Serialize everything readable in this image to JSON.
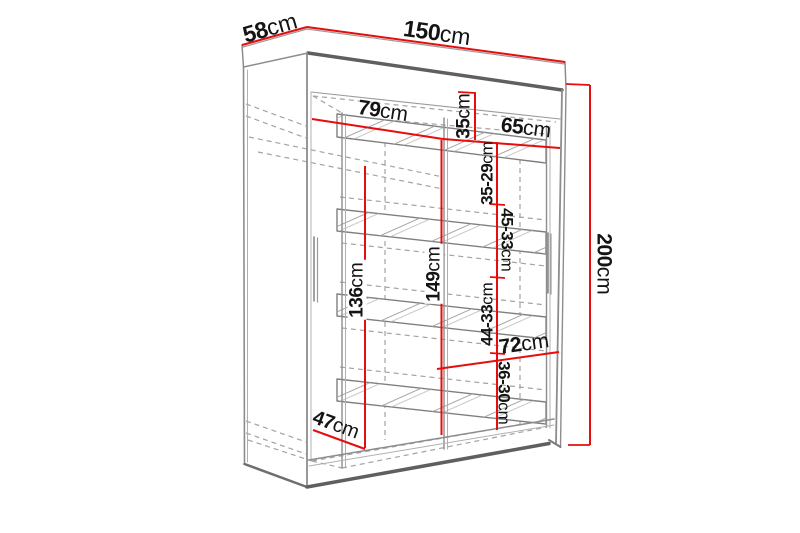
{
  "dimensions": {
    "depth": {
      "num": "58",
      "unit": "cm"
    },
    "width": {
      "num": "150",
      "unit": "cm"
    },
    "height": {
      "num": "200",
      "unit": "cm"
    },
    "left_shelf_width": {
      "num": "79",
      "unit": "cm"
    },
    "top_shelf_gap": {
      "num": "35",
      "unit": "cm"
    },
    "right_shelf_width": {
      "num": "65",
      "unit": "cm"
    },
    "right_gap_1": {
      "num": "35-29",
      "unit": "cm"
    },
    "right_gap_2": {
      "num": "45-33",
      "unit": "cm"
    },
    "hanging_space_height": {
      "num": "136",
      "unit": "cm"
    },
    "interior_height": {
      "num": "149",
      "unit": "cm"
    },
    "right_gap_3": {
      "num": "44-33",
      "unit": "cm"
    },
    "bottom_section_width": {
      "num": "72",
      "unit": "cm"
    },
    "right_gap_4": {
      "num": "36-30",
      "unit": "cm"
    },
    "interior_depth": {
      "num": "47",
      "unit": "cm"
    }
  },
  "colors": {
    "dimension_line": "#e60d0d",
    "label_text": "#141414",
    "outline": "#8d8d8d",
    "outline_dark": "#5f5f5f",
    "background": "#ffffff"
  }
}
